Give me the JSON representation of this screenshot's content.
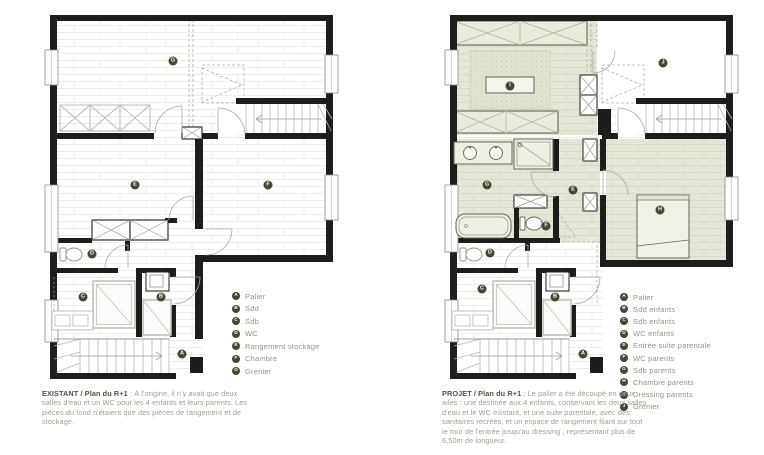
{
  "colors": {
    "badge": "#3f4a31",
    "legend_text": "#8e9681",
    "caption_title": "#4f553f",
    "caption_body": "#9aa28d",
    "wall": "#1d1d1b",
    "parental_tint": "#e4e7d8"
  },
  "panels": [
    {
      "id": "existant",
      "caption": {
        "title": "EXISTANT / Plan du R+1",
        "body": ": À l'origine, il n'y avait que deux salles d'eau et un WC pour les 4 enfants et leurs parents. Les pièces du fond n'étaient que des pièces de rangement et de stockage."
      },
      "legend": [
        {
          "letter": "A",
          "label": "Palier"
        },
        {
          "letter": "B",
          "label": "Sdd"
        },
        {
          "letter": "C",
          "label": "Sdb"
        },
        {
          "letter": "D",
          "label": "WC"
        },
        {
          "letter": "E",
          "label": "Rangement stockage"
        },
        {
          "letter": "F",
          "label": "Chambre"
        },
        {
          "letter": "G",
          "label": "Grenier"
        }
      ],
      "markers": [
        {
          "letter": "G",
          "x": 133,
          "y": 56
        },
        {
          "letter": "E",
          "x": 95,
          "y": 180
        },
        {
          "letter": "F",
          "x": 228,
          "y": 180
        },
        {
          "letter": "D",
          "x": 52,
          "y": 249
        },
        {
          "letter": "C",
          "x": 43,
          "y": 292
        },
        {
          "letter": "B",
          "x": 121,
          "y": 292
        },
        {
          "letter": "A",
          "x": 142,
          "y": 349
        }
      ]
    },
    {
      "id": "projet",
      "caption": {
        "title": "PROJET / Plan du R+1",
        "body": ": Le palier a été découpé en deux ailes : une destinée aux 4 enfants, conservant les deux salles d'eau et le WC existant, et une suite parentale, avec des sanitaires recréés, et un espace de rangement filant sur tout le mur de l'entrée jusqu'au dressing , représentant plus de 6,50m de longueur."
      },
      "legend": [
        {
          "letter": "A",
          "label": "Palier"
        },
        {
          "letter": "B",
          "label": "Sdd enfants"
        },
        {
          "letter": "C",
          "label": "Sdb enfants"
        },
        {
          "letter": "D",
          "label": "WC enfants"
        },
        {
          "letter": "E",
          "label": "Entrée suite parentale"
        },
        {
          "letter": "F",
          "label": "WC parents"
        },
        {
          "letter": "G",
          "label": "Sdb parents"
        },
        {
          "letter": "H",
          "label": "Chambre parents"
        },
        {
          "letter": "I",
          "label": "Dressing parents"
        },
        {
          "letter": "J",
          "label": "Grenier"
        }
      ],
      "markers": [
        {
          "letter": "I",
          "x": 70,
          "y": 81
        },
        {
          "letter": "J",
          "x": 223,
          "y": 58
        },
        {
          "letter": "G",
          "x": 47,
          "y": 180
        },
        {
          "letter": "E",
          "x": 133,
          "y": 185
        },
        {
          "letter": "F",
          "x": 106,
          "y": 221
        },
        {
          "letter": "H",
          "x": 220,
          "y": 205
        },
        {
          "letter": "D",
          "x": 50,
          "y": 248
        },
        {
          "letter": "C",
          "x": 42,
          "y": 284
        },
        {
          "letter": "B",
          "x": 115,
          "y": 292
        },
        {
          "letter": "A",
          "x": 143,
          "y": 349
        }
      ]
    }
  ]
}
